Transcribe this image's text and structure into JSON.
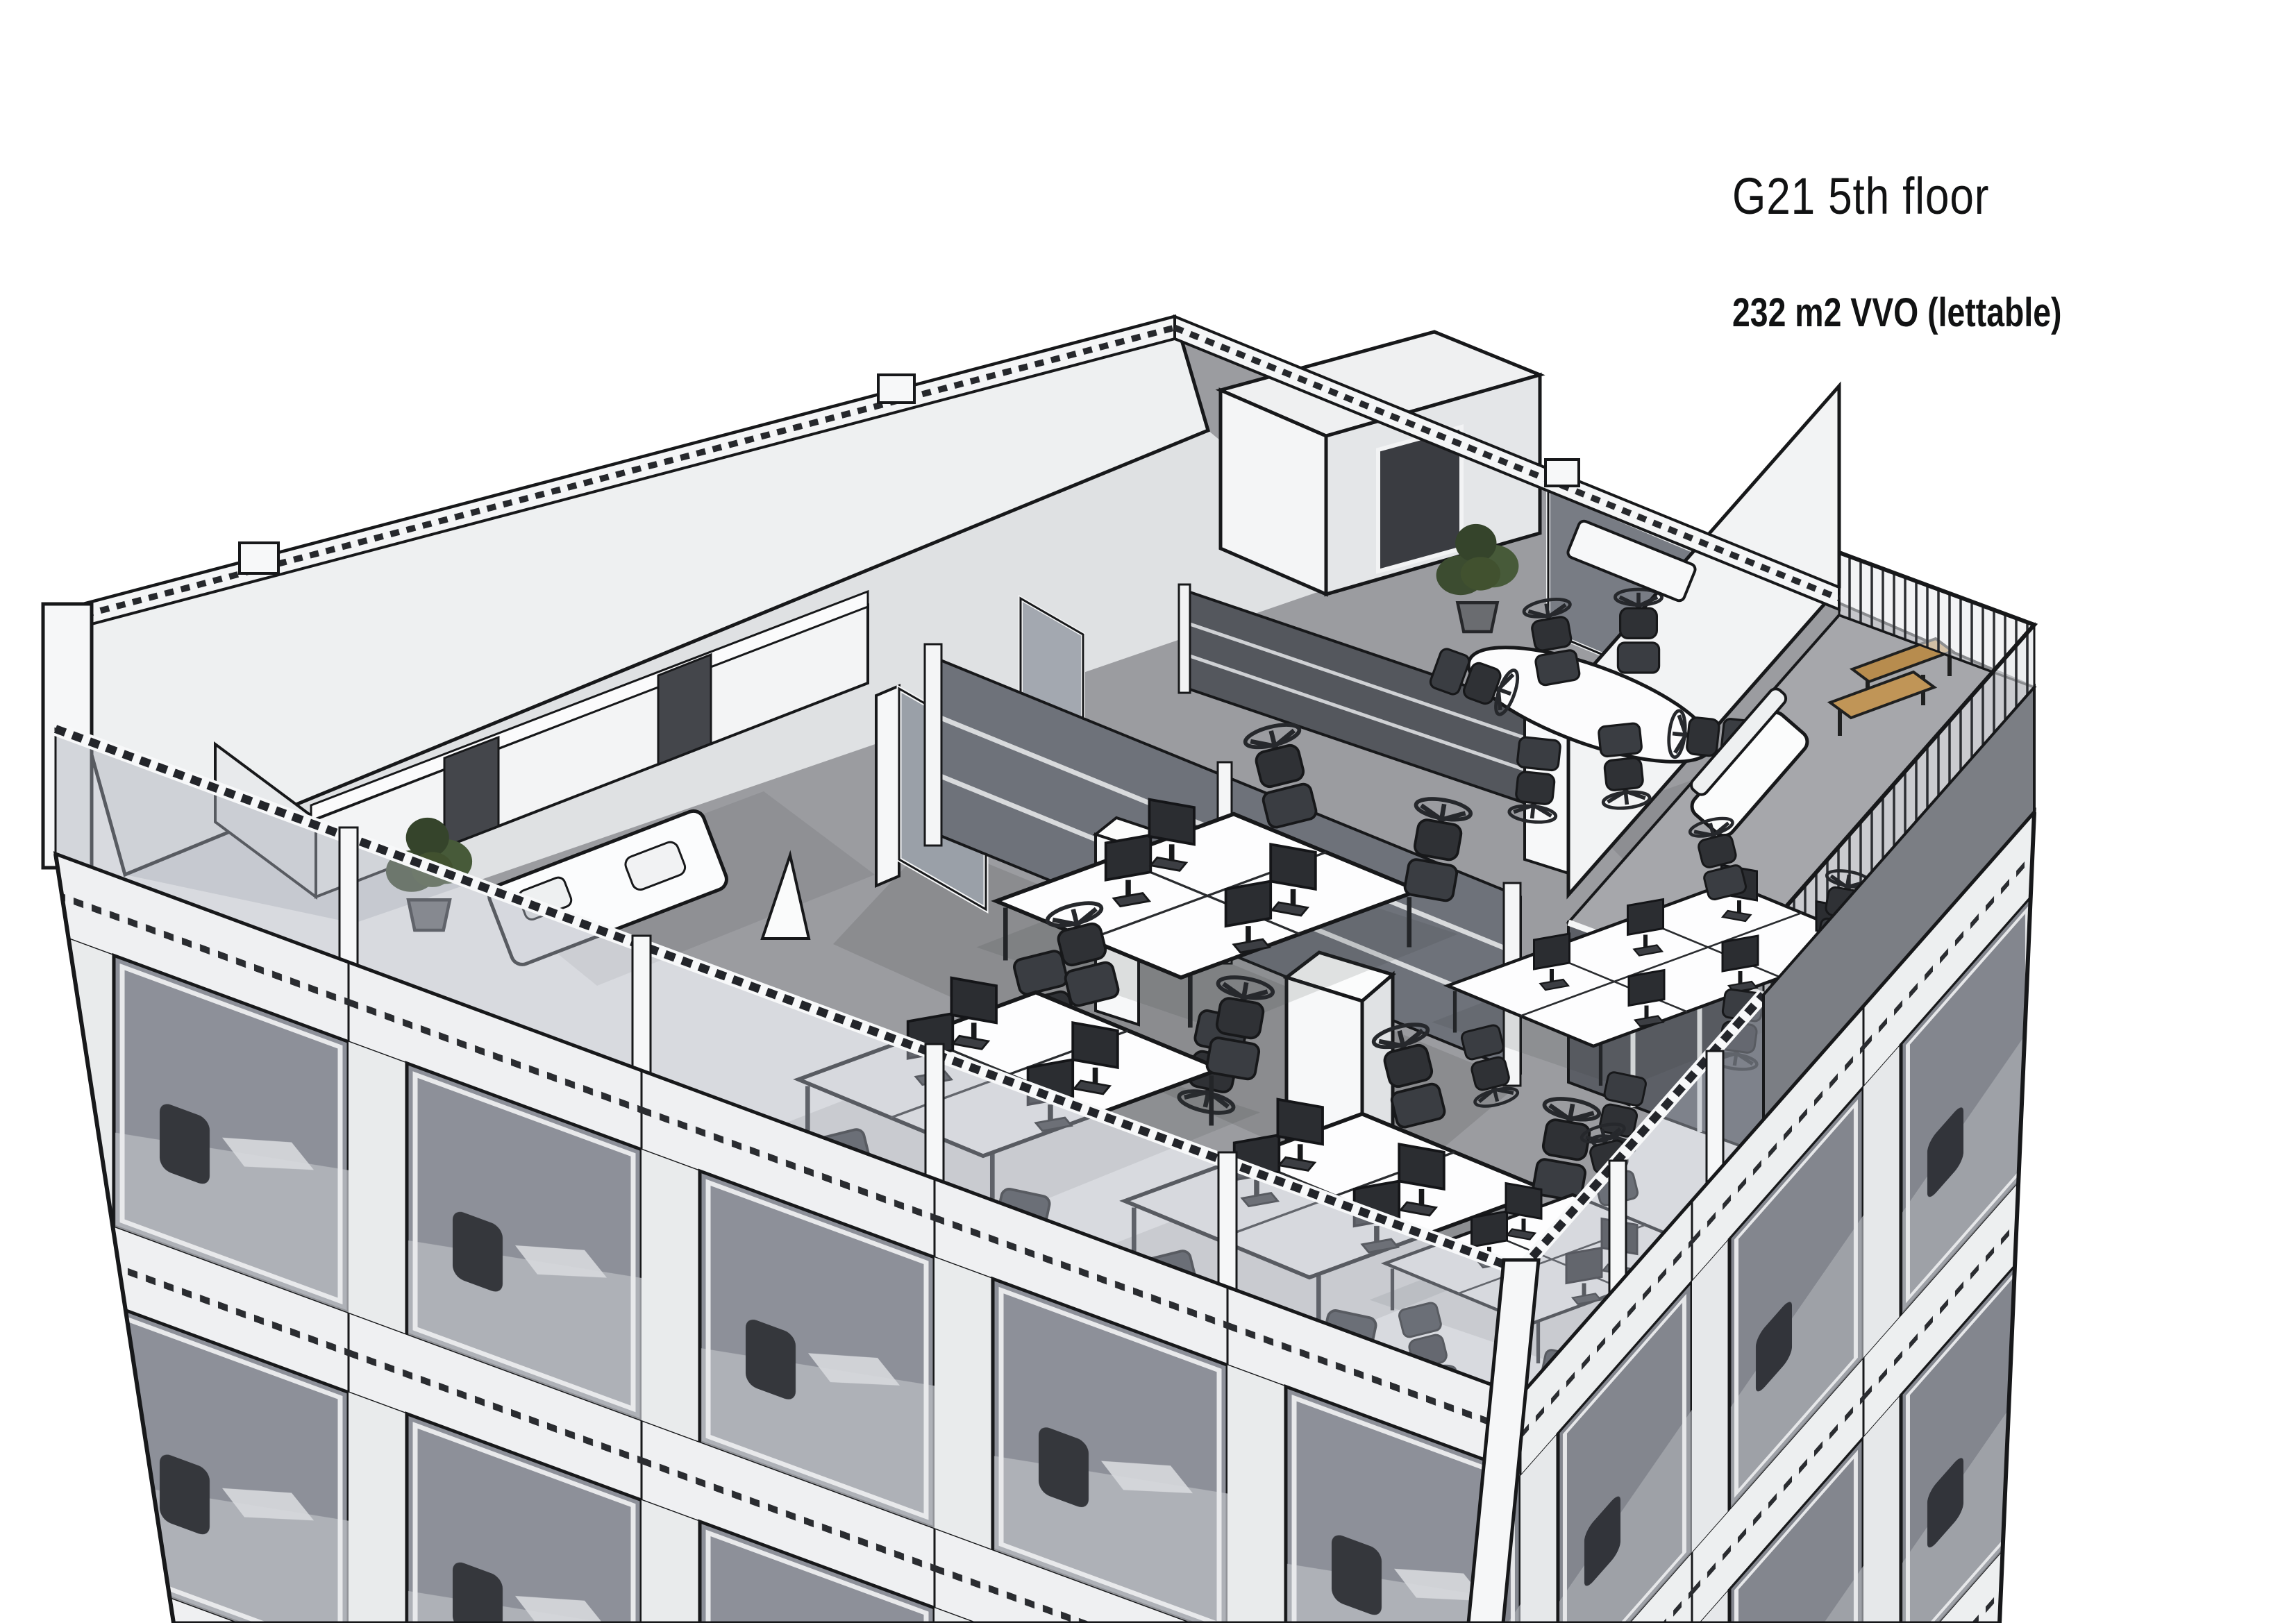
{
  "annotation": {
    "title": "G21 5th floor",
    "subtitle": "232 m2 VVO (lettable)"
  },
  "scene": {
    "type": "3d-architectural-cutaway-rendering",
    "subject": "office tower corner view, 5th floor cut open showing open-plan office layout with desk clusters, meeting area and roof terrace",
    "palette": {
      "background": "#ffffff",
      "ink": "#17181a",
      "floor": "#9b9ca0",
      "corridor_floor": "#dfe1e3",
      "wall_white": "#f3f4f5",
      "wall_shade": "#e4e6e8",
      "facade_glass": "#8d9099",
      "facade_glass_right": "#83868e",
      "partition_glass": "#6e727a",
      "balustrade_glass": "rgba(168,174,184,0.45)",
      "terrace_deck": "#a6a7ab",
      "terrace_fascia": "#7b7e84",
      "bench_wood": "#c09557",
      "plant_green": "#41512f",
      "furniture_dark": "#2f3135",
      "desk_white": "#fdfdfe"
    }
  }
}
